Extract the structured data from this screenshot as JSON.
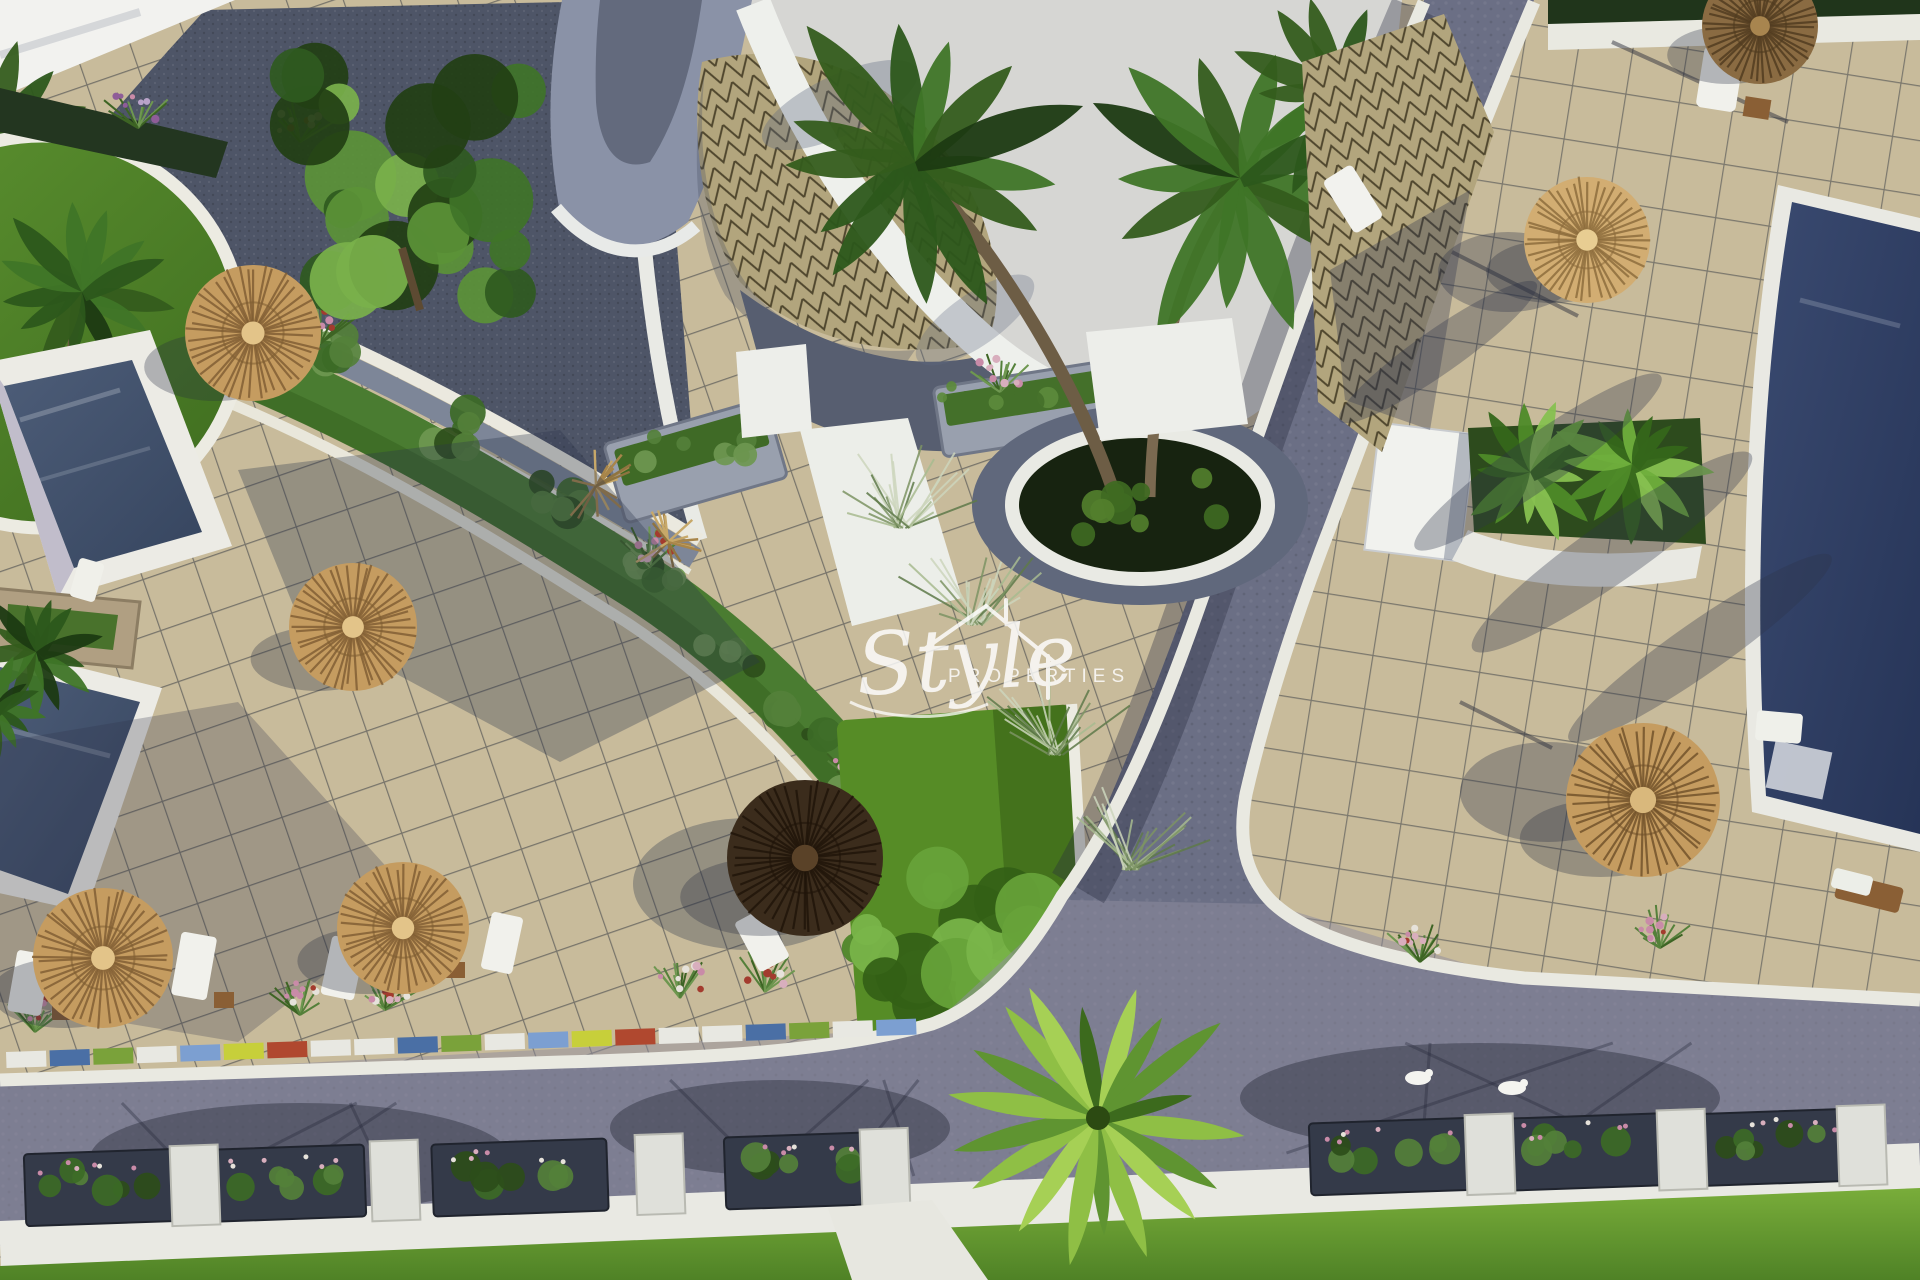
{
  "scene": {
    "type": "aerial-3d-architectural-render",
    "subject": "Aerial render of a residential resort: swimming pools, beige tiled terraces, thatched straw parasols, sun loungers, palm trees, landscaped planters, paved streets and lawns",
    "parasol_count": 8,
    "pools_visible": 3
  },
  "watermark": {
    "script": "Style",
    "caps": "PROPERTIES",
    "color": "#ffffff"
  },
  "palette": {
    "sky": "#d6d6d3",
    "terrace": "#c8bb9b",
    "terrace_shadow": "#7e8494",
    "gravel_roof": "#4e5567",
    "dome_tile": "#b2a57d",
    "street": "#6b6f85",
    "street_light": "#908da0",
    "curb_white": "#e9e9e1",
    "pool_left": "#43536d",
    "pool_right": "#2e3e63",
    "lawn": "#66982e",
    "lawn_square": "#568c26",
    "garden_green": "#4a7c31",
    "tree_green": "#3f7428",
    "palm_green": "#2c571b",
    "straw": "#c59c60",
    "straw_dark": "#3b2c1c",
    "stone_planter": "#99a0ae",
    "flower_pink": "#c98ba8",
    "white_structure": "#eef0ec"
  }
}
